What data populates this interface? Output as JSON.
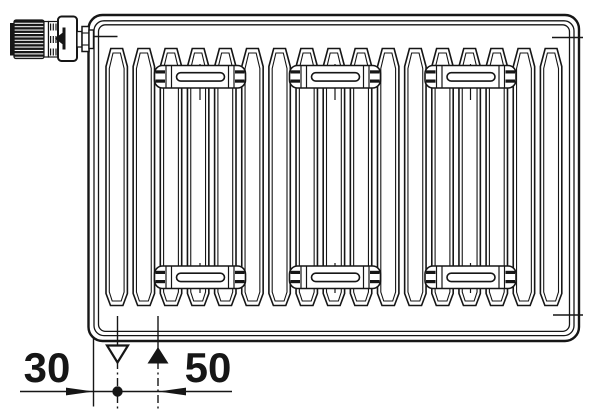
{
  "drawing": {
    "kind": "panel-radiator-technical-drawing",
    "line_color": "#161616",
    "background": "#ffffff",
    "radiator": {
      "fin_count": 17,
      "bracket_columns": 3,
      "bracket_rows": 2
    },
    "valve": {
      "type": "thermostatic-valve-head",
      "position": "top-left"
    }
  },
  "dimensions": [
    {
      "label": "30",
      "symbol": "supply-connection-open-triangle-down"
    },
    {
      "label": "50",
      "symbol": "return-connection-filled-triangle-up"
    }
  ]
}
